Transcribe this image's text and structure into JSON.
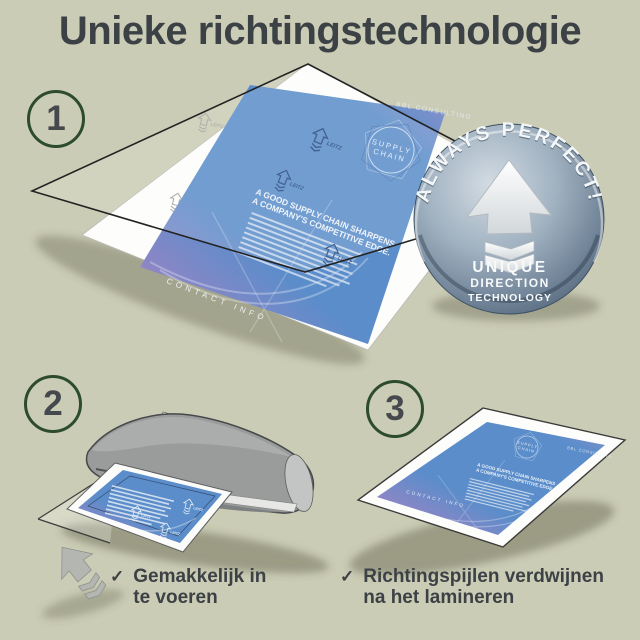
{
  "page": {
    "title": "Unieke richtingstechnologie"
  },
  "steps": [
    {
      "number": "1"
    },
    {
      "number": "2"
    },
    {
      "number": "3"
    }
  ],
  "badge": {
    "arc_text": "ALWAYS PERFECT!",
    "line1": "UNIQUE",
    "line2": "DIRECTION",
    "line3": "TECHNOLOGY"
  },
  "flyer": {
    "brand": "BBL CONSULTING",
    "logo_line1": "SUPPLY",
    "logo_line2": "CHAIN",
    "headline_line1": "A GOOD SUPPLY CHAIN SHARPENS",
    "headline_line2": "A COMPANY'S COMPETITIVE EDGE.",
    "footer": "CONTACT INFO",
    "watermark": "LEITZ"
  },
  "checklist": [
    {
      "mark": "✓",
      "line1": "Gemakkelijk in",
      "line2": "te voeren"
    },
    {
      "mark": "✓",
      "line1": "Richtingspijlen verdwijnen",
      "line2": "na het lamineren"
    }
  ],
  "colors": {
    "background": "#cbccb5",
    "text": "#3b4145",
    "step_ring_green": "#2d4b2d",
    "flyer_blue": "#5a8dca",
    "flyer_violet": "#8d86c6",
    "badge_light": "#d3dce4",
    "badge_dark": "#4c5f73",
    "laminator_gray": "#999c9b",
    "arrow_gray": "#b4b6b1"
  }
}
